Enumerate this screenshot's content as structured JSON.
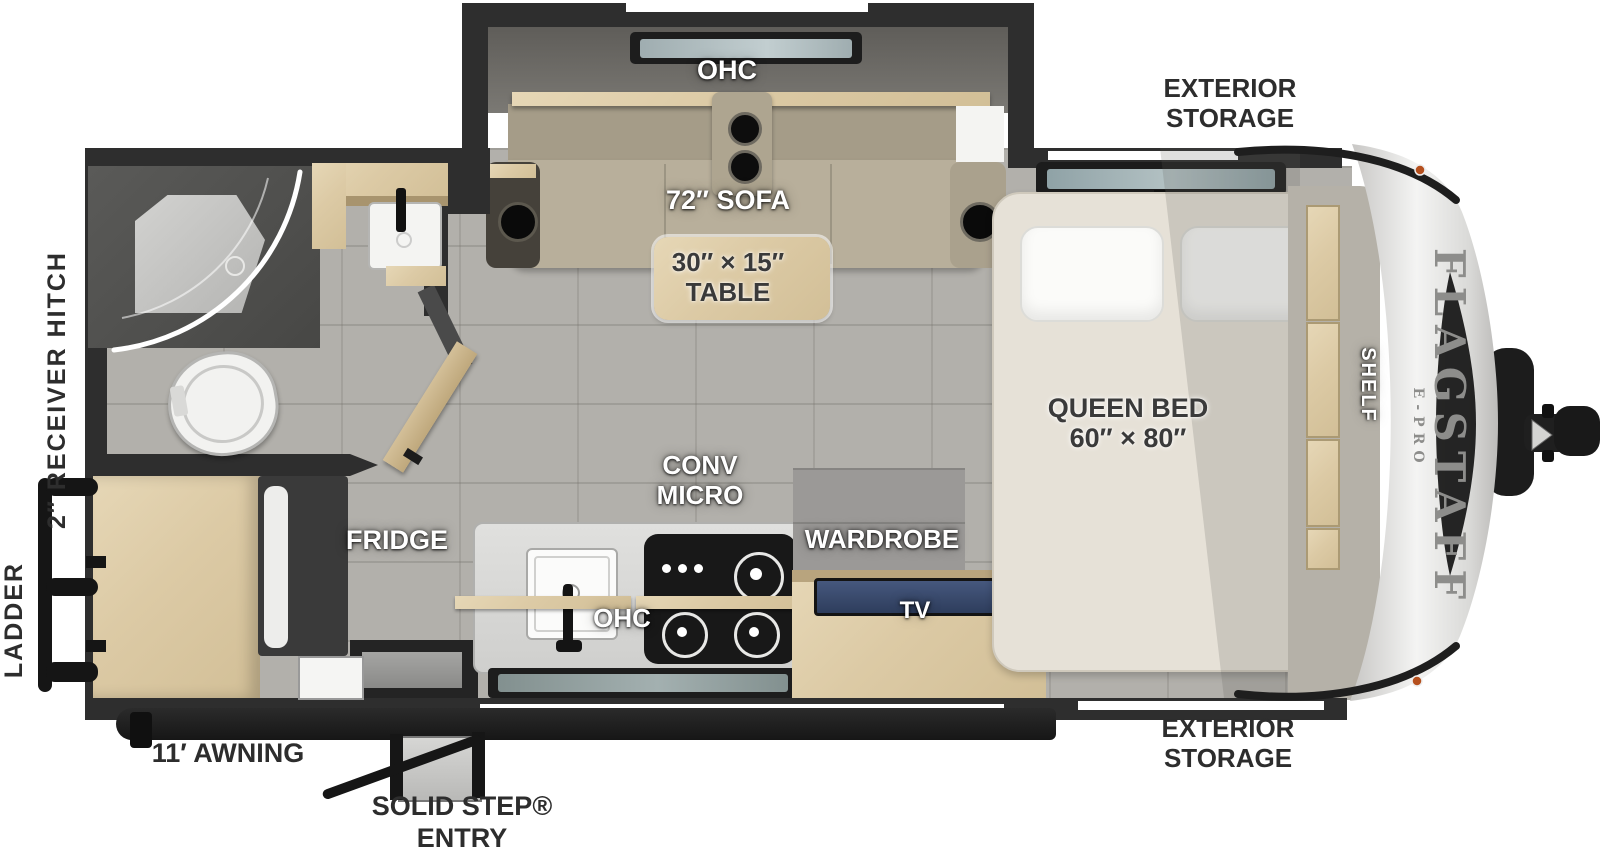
{
  "diagram": {
    "title": "Flagstaff E-Pro travel trailer floor plan",
    "brand": {
      "name": "FLAGSTAFF",
      "sub": "E-PRO"
    },
    "labels": {
      "ohc_slide": "OHC",
      "sofa": "72″ SOFA",
      "table_size": "30″ × 15″",
      "table": "TABLE",
      "exterior_storage_line1": "EXTERIOR",
      "exterior_storage_line2": "STORAGE",
      "queen_bed": "QUEEN BED",
      "queen_bed_size": "60″ × 80″",
      "shelf": "SHELF",
      "conv": "CONV",
      "micro": "MICRO",
      "fridge": "FRIDGE",
      "ohc_kitchen": "OHC",
      "wardrobe": "WARDROBE",
      "tv": "TV",
      "receiver_hitch": "2″ RECEIVER HITCH",
      "ladder": "LADDER",
      "awning": "11′ AWNING",
      "solid_step": "SOLID STEP®",
      "entry": "ENTRY"
    },
    "colors": {
      "wall": "#2e2e2e",
      "floor": "#b2b0ab",
      "wood": "#dccaa5",
      "sofa": "#b8af9b",
      "mattress": "#e6e1d7",
      "counter": "#d8d8d6",
      "stove": "#181818",
      "cap": "#eeeeec",
      "awning": "#1f1f1f",
      "tv_screen": "#2e3d5c",
      "marker_light": "#b5501e"
    }
  }
}
